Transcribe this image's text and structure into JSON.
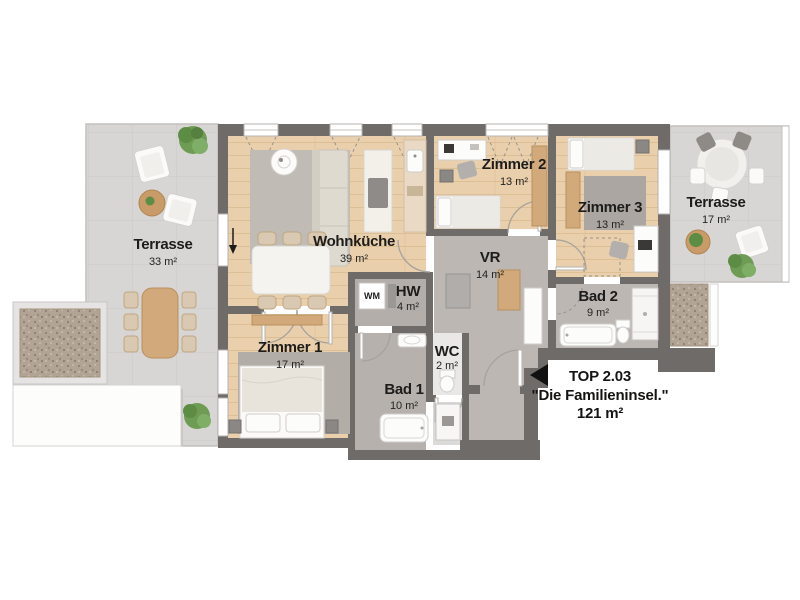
{
  "unit": {
    "top": "TOP 2.03",
    "name": "\"Die Familieninsel.\"",
    "area": "121 m²"
  },
  "rooms": {
    "terrasse_left": {
      "label": "Terrasse",
      "area": "33 m²"
    },
    "wohnkueche": {
      "label": "Wohnküche",
      "area": "39 m²"
    },
    "zimmer1": {
      "label": "Zimmer 1",
      "area": "17 m²"
    },
    "zimmer2": {
      "label": "Zimmer 2",
      "area": "13 m²"
    },
    "zimmer3": {
      "label": "Zimmer 3",
      "area": "13 m²"
    },
    "terrasse_right": {
      "label": "Terrasse",
      "area": "17 m²"
    },
    "vr": {
      "label": "VR",
      "area": "14 m²"
    },
    "hw": {
      "label": "HW",
      "area": "4 m²"
    },
    "wc": {
      "label": "WC",
      "area": "2 m²"
    },
    "bad1": {
      "label": "Bad 1",
      "area": "10 m²"
    },
    "bad2": {
      "label": "Bad 2",
      "area": "9 m²"
    }
  },
  "appliances": {
    "washing_machine": "WM"
  },
  "colors": {
    "wall": "#6f6b69",
    "wood_floor": "#e9cfab",
    "terrace_tile": "#d8d6d4",
    "concrete_floor": "#bcb7b3",
    "gravel": "#b2a494",
    "plant": "#6f9c55",
    "text": "#1d1c1a"
  }
}
